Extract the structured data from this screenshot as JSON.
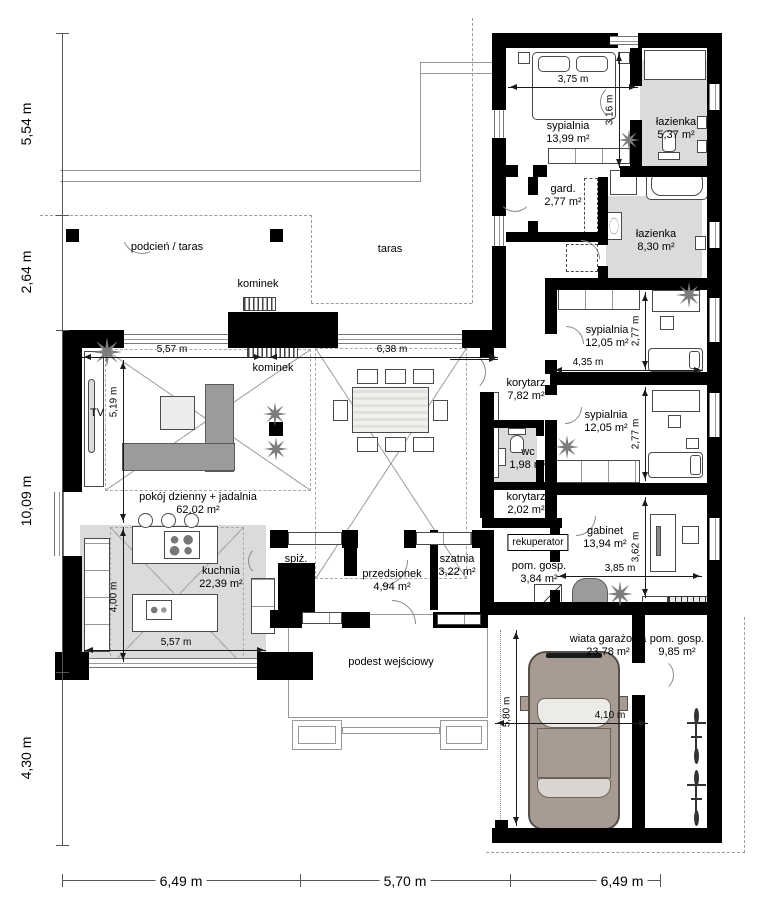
{
  "plan": {
    "chain_left": [
      "5,54 m",
      "2,64 m",
      "10,09 m",
      "4,30 m"
    ],
    "chain_bottom": [
      "6,49 m",
      "5,70 m",
      "6,49 m"
    ],
    "rooms": {
      "sypialnia_top": {
        "name": "sypialnia",
        "area": "13,99 m²"
      },
      "lazienka_top": {
        "name": "łazienka",
        "area": "5,37 m²"
      },
      "gard": {
        "name": "gard.",
        "area": "2,77 m²"
      },
      "lazienka_big": {
        "name": "łazienka",
        "area": "8,30 m²"
      },
      "sypialnia_mid": {
        "name": "sypialnia",
        "area": "12,05 m²"
      },
      "korytarz_main": {
        "name": "korytarz",
        "area": "7,82 m²"
      },
      "wc": {
        "name": "wc",
        "area": "1,98 m²"
      },
      "sypialnia_low": {
        "name": "sypialnia",
        "area": "12,05 m²"
      },
      "korytarz_small": {
        "name": "korytarz",
        "area": "2,02 m²"
      },
      "gabinet": {
        "name": "gabinet",
        "area": "13,94 m²"
      },
      "pom_gosp_small": {
        "name": "pom. gosp.",
        "area": "3,84 m²"
      },
      "pokoj_dzienny": {
        "name": "pokój dzienny + jadalnia",
        "area": "62,02 m²"
      },
      "kuchnia": {
        "name": "kuchnia",
        "area": "22,39 m²"
      },
      "spiz": {
        "name": "spiż.",
        "area": "3,22 m²"
      },
      "przedsionek": {
        "name": "przedsionek",
        "area": "4,94 m²"
      },
      "szatnia": {
        "name": "szatnia",
        "area": "3,22 m²"
      },
      "wiata": {
        "name": "wiata garażowa",
        "area": "23,78 m²"
      },
      "pom_gosp_big": {
        "name": "pom. gosp.",
        "area": "9,85 m²"
      }
    },
    "labels": {
      "podcien_taras": "podcień / taras",
      "taras": "taras",
      "kominek_outside": "kominek",
      "kominek_inside": "kominek",
      "tv": "TV",
      "rekuperator": "rekuperator",
      "podest": "podest wejściowy"
    },
    "inner_dims": {
      "bedroom_w": "3,75 m",
      "bedroom_h": "3,16 m",
      "living_w": "5,57 m",
      "dining_w": "6,38 m",
      "living_h": "5,19 m",
      "syp1_w": "4,35 m",
      "syp1_h": "2,77 m",
      "syp2_h": "2,77 m",
      "gabinet_h": "3,62 m",
      "gabinet_w": "3,85 m",
      "kitchen_h": "4,00 m",
      "kitchen_w": "5,57 m",
      "garage_h": "5,80 m",
      "garage_w": "4,10 m"
    },
    "icons": {
      "plant": "star-burst-plant",
      "car": "car-top-view",
      "bicycle": "bicycle-top-view"
    },
    "colors": {
      "wall": "#000000",
      "floor_gray": "#dbdbdb",
      "furniture_gray": "#9b9b9b",
      "car_body": "#a79b94"
    }
  }
}
